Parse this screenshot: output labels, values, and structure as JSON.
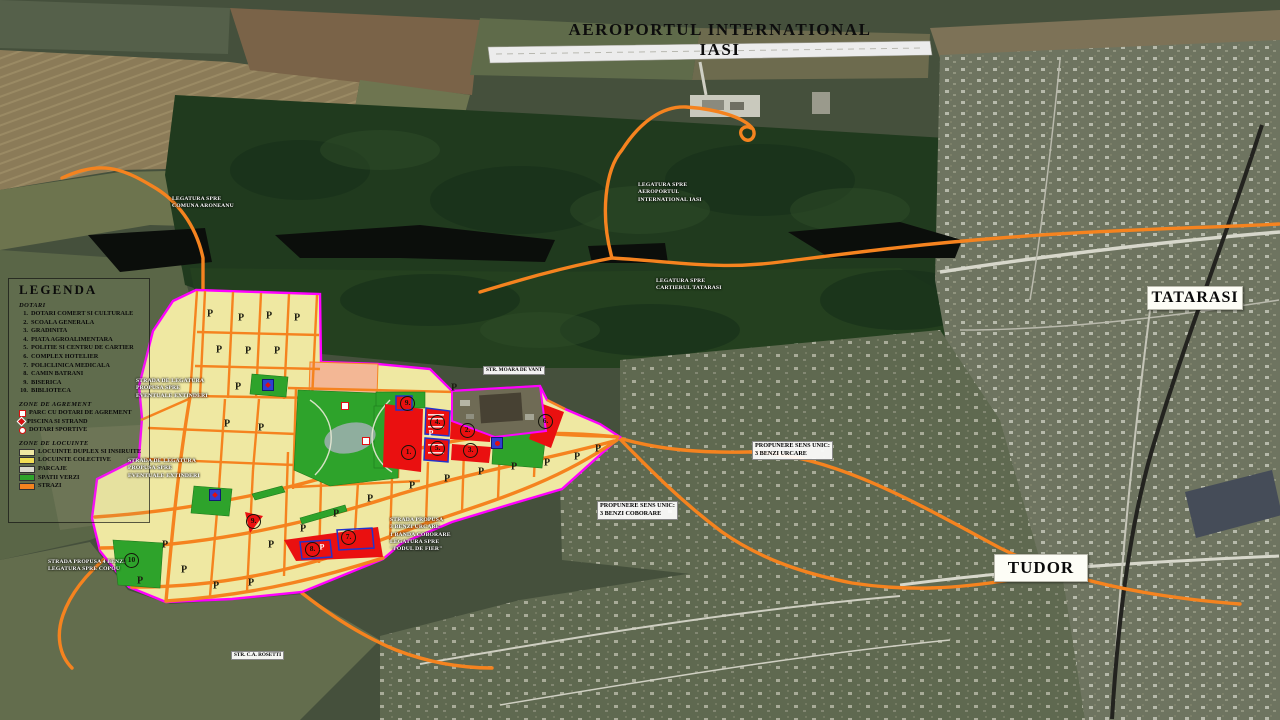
{
  "title": {
    "text": "AEROPORTUL INTERNATIONAL IASI"
  },
  "regions": [
    {
      "name": "tatarasi",
      "text": "TATARASI"
    },
    {
      "name": "tudor",
      "text": "TUDOR"
    }
  ],
  "legend": {
    "title": "LEGENDA",
    "sections": [
      {
        "header": "DOTARI",
        "type": "numbered",
        "items": [
          "DOTARI COMERT SI CULTURALE",
          "SCOALA GENERALA",
          "GRADINITA",
          "PIATA AGROALIMENTARA",
          "POLITIE SI CENTRU DE CARTIER",
          "COMPLEX HOTELIER",
          "POLICLINICA MEDICALA",
          "CAMIN BATRANI",
          "BISERICA",
          "BIBLIOTECA"
        ]
      },
      {
        "header": "ZONE DE AGREMENT",
        "type": "icons",
        "items": [
          {
            "icon": "red-square-icon",
            "label": "PARC CU DOTARI DE AGREMENT"
          },
          {
            "icon": "red-diamond-icon",
            "label": "PISCINA SI STRAND"
          },
          {
            "icon": "red-circle-icon",
            "label": "DOTARI SPORTIVE"
          }
        ]
      },
      {
        "header": "ZONE DE LOCUINTE",
        "type": "swatches",
        "items": [
          {
            "color": "#efe8a2",
            "label": "LOCUINTE DUPLEX SI INSIRUITE"
          },
          {
            "color": "#f2df55",
            "label": "LOCUINTE COLECTIVE"
          },
          {
            "color": "#d9d9cd",
            "label": "PARCAJE"
          },
          {
            "color": "#2ea32b",
            "label": "SPATII VERZI"
          },
          {
            "color": "#f5831f",
            "label": "STRAZI"
          }
        ]
      }
    ]
  },
  "labels": [
    {
      "name": "label-legatura-aroneanu",
      "style": "plain",
      "x": 172,
      "y": 196,
      "text": "LEGATURA SPRE\nCOMUNA ARONEANU"
    },
    {
      "name": "label-legatura-aeroport",
      "style": "plain",
      "x": 638,
      "y": 182,
      "text": "LEGATURA SPRE\nAEROPORTUL\nINTERNATIONAL IASI"
    },
    {
      "name": "label-legatura-tatarasi",
      "style": "plain",
      "x": 656,
      "y": 278,
      "text": "LEGATURA SPRE\nCARTIERUL TATARASI"
    },
    {
      "name": "label-strada-legatura-1",
      "style": "plain",
      "x": 136,
      "y": 378,
      "text": "STRADA DE LEGATURA\nPROPUSA SPRE\nEVENTUALE EXTINDERI"
    },
    {
      "name": "label-strada-legatura-2",
      "style": "plain",
      "x": 128,
      "y": 458,
      "text": "STRADA DE LEGATURA\nPROPUSA SPRE\nEVENTUALE EXTINDERI"
    },
    {
      "name": "label-moara-de-vant",
      "style": "boxed-sm",
      "x": 483,
      "y": 366,
      "text": "STR. MOARA DE VANT"
    },
    {
      "name": "label-propunere-urcare",
      "style": "boxed",
      "x": 752,
      "y": 441,
      "text": "PROPUNERE SENS UNIC:\n3 BENZI URCARE"
    },
    {
      "name": "label-propunere-coborare",
      "style": "boxed",
      "x": 597,
      "y": 501,
      "text": "PROPUNERE SENS UNIC:\n3 BENZI COBORARE"
    },
    {
      "name": "label-strada-podul-fier",
      "style": "plain",
      "x": 390,
      "y": 517,
      "text": "STRADA PROPUSA\n3 BENZI URCARE\n1 BANDA COBORARE\nLEGATURA SPRE\n\"PODUL DE FIER\""
    },
    {
      "name": "label-strada-copou",
      "style": "plain",
      "x": 48,
      "y": 559,
      "text": "STRADA PROPUSA 4 BENZI\nLEGATURA SPRE COPOU"
    },
    {
      "name": "label-rosetti",
      "style": "boxed-sm",
      "x": 231,
      "y": 651,
      "text": "STR. C.A. ROSETTI"
    }
  ],
  "markers": {
    "numbered": [
      {
        "label": "1.",
        "x": 408,
        "y": 452
      },
      {
        "label": "2.",
        "x": 467,
        "y": 430
      },
      {
        "label": "3.",
        "x": 470,
        "y": 450
      },
      {
        "label": "4.",
        "x": 437,
        "y": 422
      },
      {
        "label": "5.",
        "x": 437,
        "y": 448
      },
      {
        "label": "6.",
        "x": 545,
        "y": 421
      },
      {
        "label": "7.",
        "x": 348,
        "y": 537
      },
      {
        "label": "8.",
        "x": 312,
        "y": 549
      },
      {
        "label": "9.",
        "x": 407,
        "y": 403
      },
      {
        "label": "9.",
        "x": 253,
        "y": 521
      },
      {
        "label": "10",
        "x": 131,
        "y": 560
      }
    ],
    "parking_black": [
      [
        210,
        314
      ],
      [
        241,
        318
      ],
      [
        269,
        316
      ],
      [
        297,
        318
      ],
      [
        219,
        350
      ],
      [
        248,
        351
      ],
      [
        277,
        351
      ],
      [
        238,
        387
      ],
      [
        454,
        388
      ],
      [
        227,
        424
      ],
      [
        261,
        428
      ],
      [
        412,
        486
      ],
      [
        447,
        479
      ],
      [
        481,
        472
      ],
      [
        514,
        467
      ],
      [
        547,
        463
      ],
      [
        577,
        457
      ],
      [
        598,
        449
      ],
      [
        370,
        499
      ],
      [
        336,
        514
      ],
      [
        303,
        529
      ],
      [
        271,
        545
      ],
      [
        165,
        545
      ],
      [
        184,
        570
      ],
      [
        216,
        586
      ],
      [
        251,
        583
      ],
      [
        140,
        581
      ]
    ],
    "parking_white": [
      [
        322,
        547
      ],
      [
        431,
        433
      ]
    ],
    "amenities": [
      {
        "type": "pool",
        "x": 268,
        "y": 385
      },
      {
        "type": "pool",
        "x": 215,
        "y": 495
      },
      {
        "type": "sport",
        "x": 497,
        "y": 443
      },
      {
        "type": "park",
        "x": 345,
        "y": 406
      },
      {
        "type": "park",
        "x": 366,
        "y": 441
      }
    ]
  },
  "colors": {
    "zone_duplex": "#efe8a2",
    "zone_colective": "#f2df55",
    "zone_parcaje": "#d9d9cd",
    "zone_verzi": "#2ea32b",
    "zone_strazi": "#f5831f",
    "facility_red": "#ea1010",
    "boundary_magenta": "#ff00ff",
    "marker_blue": "#2f3fd0",
    "salmon_zone": "#f3b795"
  }
}
